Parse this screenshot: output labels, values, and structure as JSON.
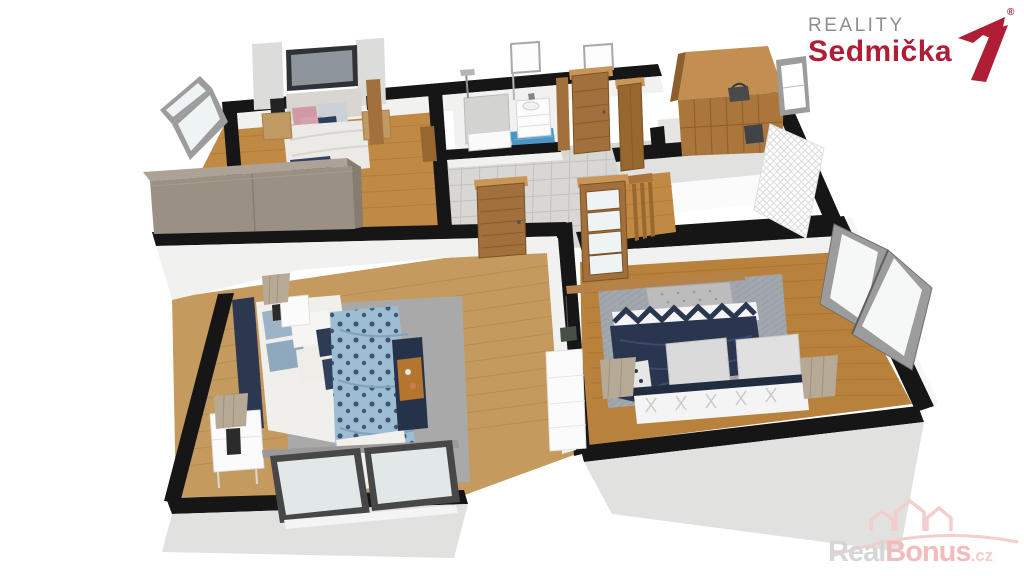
{
  "brand": {
    "line1": "REALITY",
    "line2": "Sedmička",
    "registered_mark": "®",
    "mark_icon": "stylized-seven"
  },
  "watermark": {
    "part1": "Real",
    "part2": "Bonus",
    "part3": ".cz",
    "icon": "three-houses-with-arc"
  },
  "scene": {
    "description": "3D isometric render of an upper-floor plan with two large bedrooms, a small bedroom, bathroom, hallway with staircase and a walk-in wardrobe",
    "rooms": [
      {
        "id": "bedroom-small",
        "furniture": [
          "double-bed",
          "tv-panel",
          "wall-lamps",
          "nightstands",
          "large-wardrobe",
          "open-window"
        ]
      },
      {
        "id": "bathroom",
        "furniture": [
          "shower",
          "vanity-sink",
          "standing-mirrors",
          "blue-mosaic-floor"
        ]
      },
      {
        "id": "hallway",
        "furniture": [
          "wooden-doors",
          "staircase",
          "railing",
          "tile-floor"
        ]
      },
      {
        "id": "walk-in-wardrobe",
        "furniture": [
          "corner-wardrobe",
          "baskets",
          "window",
          "lattice-screen"
        ]
      },
      {
        "id": "bedroom-master",
        "furniture": [
          "double-bed",
          "patterned-duvet",
          "bench-with-tray",
          "nightstands",
          "drum-lamps",
          "gray-rug",
          "sliding-window"
        ]
      },
      {
        "id": "bedroom-second",
        "furniture": [
          "double-bed",
          "navy-duvet",
          "chevron-runner",
          "tufted-bench",
          "lattice-footboard",
          "drum-lamps",
          "dresser",
          "hanging-plant",
          "casement-window"
        ]
      }
    ]
  },
  "colors": {
    "brand_red": "#b01e35",
    "brand_gray": "#8e8e8e",
    "wm_gray": "#d6d6d6",
    "wm_pink": "#f0bcbc",
    "wm_pink_light": "#f4cdcd",
    "wall_top": "#161616",
    "wall_inner": "#f1f1f0",
    "wall_outer": "#e1e1e0",
    "floor_oak1": "#c18a44",
    "floor_oak1_line": "#a8712e",
    "floor_oak2": "#c49a5e",
    "floor_oak2_line": "#aa7f46",
    "floor_oak3": "#b8813c",
    "floor_oak3_line": "#9e6a2a",
    "tile_hall": "#d8d7d3",
    "tile_grout": "#c2c1bd",
    "tile_blue": "#4a96c4",
    "rug1": "#a9a9a9",
    "rug2": "#a2a6ad",
    "taupe": "#9a9083",
    "taupe_top": "#aca295",
    "taupe_side": "#867c6f",
    "oak_front": "#aa763c",
    "oak_top": "#c28e52",
    "oak_side": "#8d5f2c",
    "door": "#a1703c",
    "door_dark": "#7c5224",
    "lintel": "#c9965a",
    "navy": "#2a3550",
    "navy_fold": "#3d4a6a",
    "blanket": "#9dbdd2",
    "pink": "#cf9aa4",
    "lamp": "#b6aa96",
    "lamp_rib": "#9e9280",
    "white_furn": "#fbfbfb",
    "glass": "#eef3f3",
    "frame_light": "#9c9c9c",
    "frame_dark": "#474747",
    "bench_gray": "#bcbcbc",
    "mirror_frame": "#a8a8a8"
  }
}
